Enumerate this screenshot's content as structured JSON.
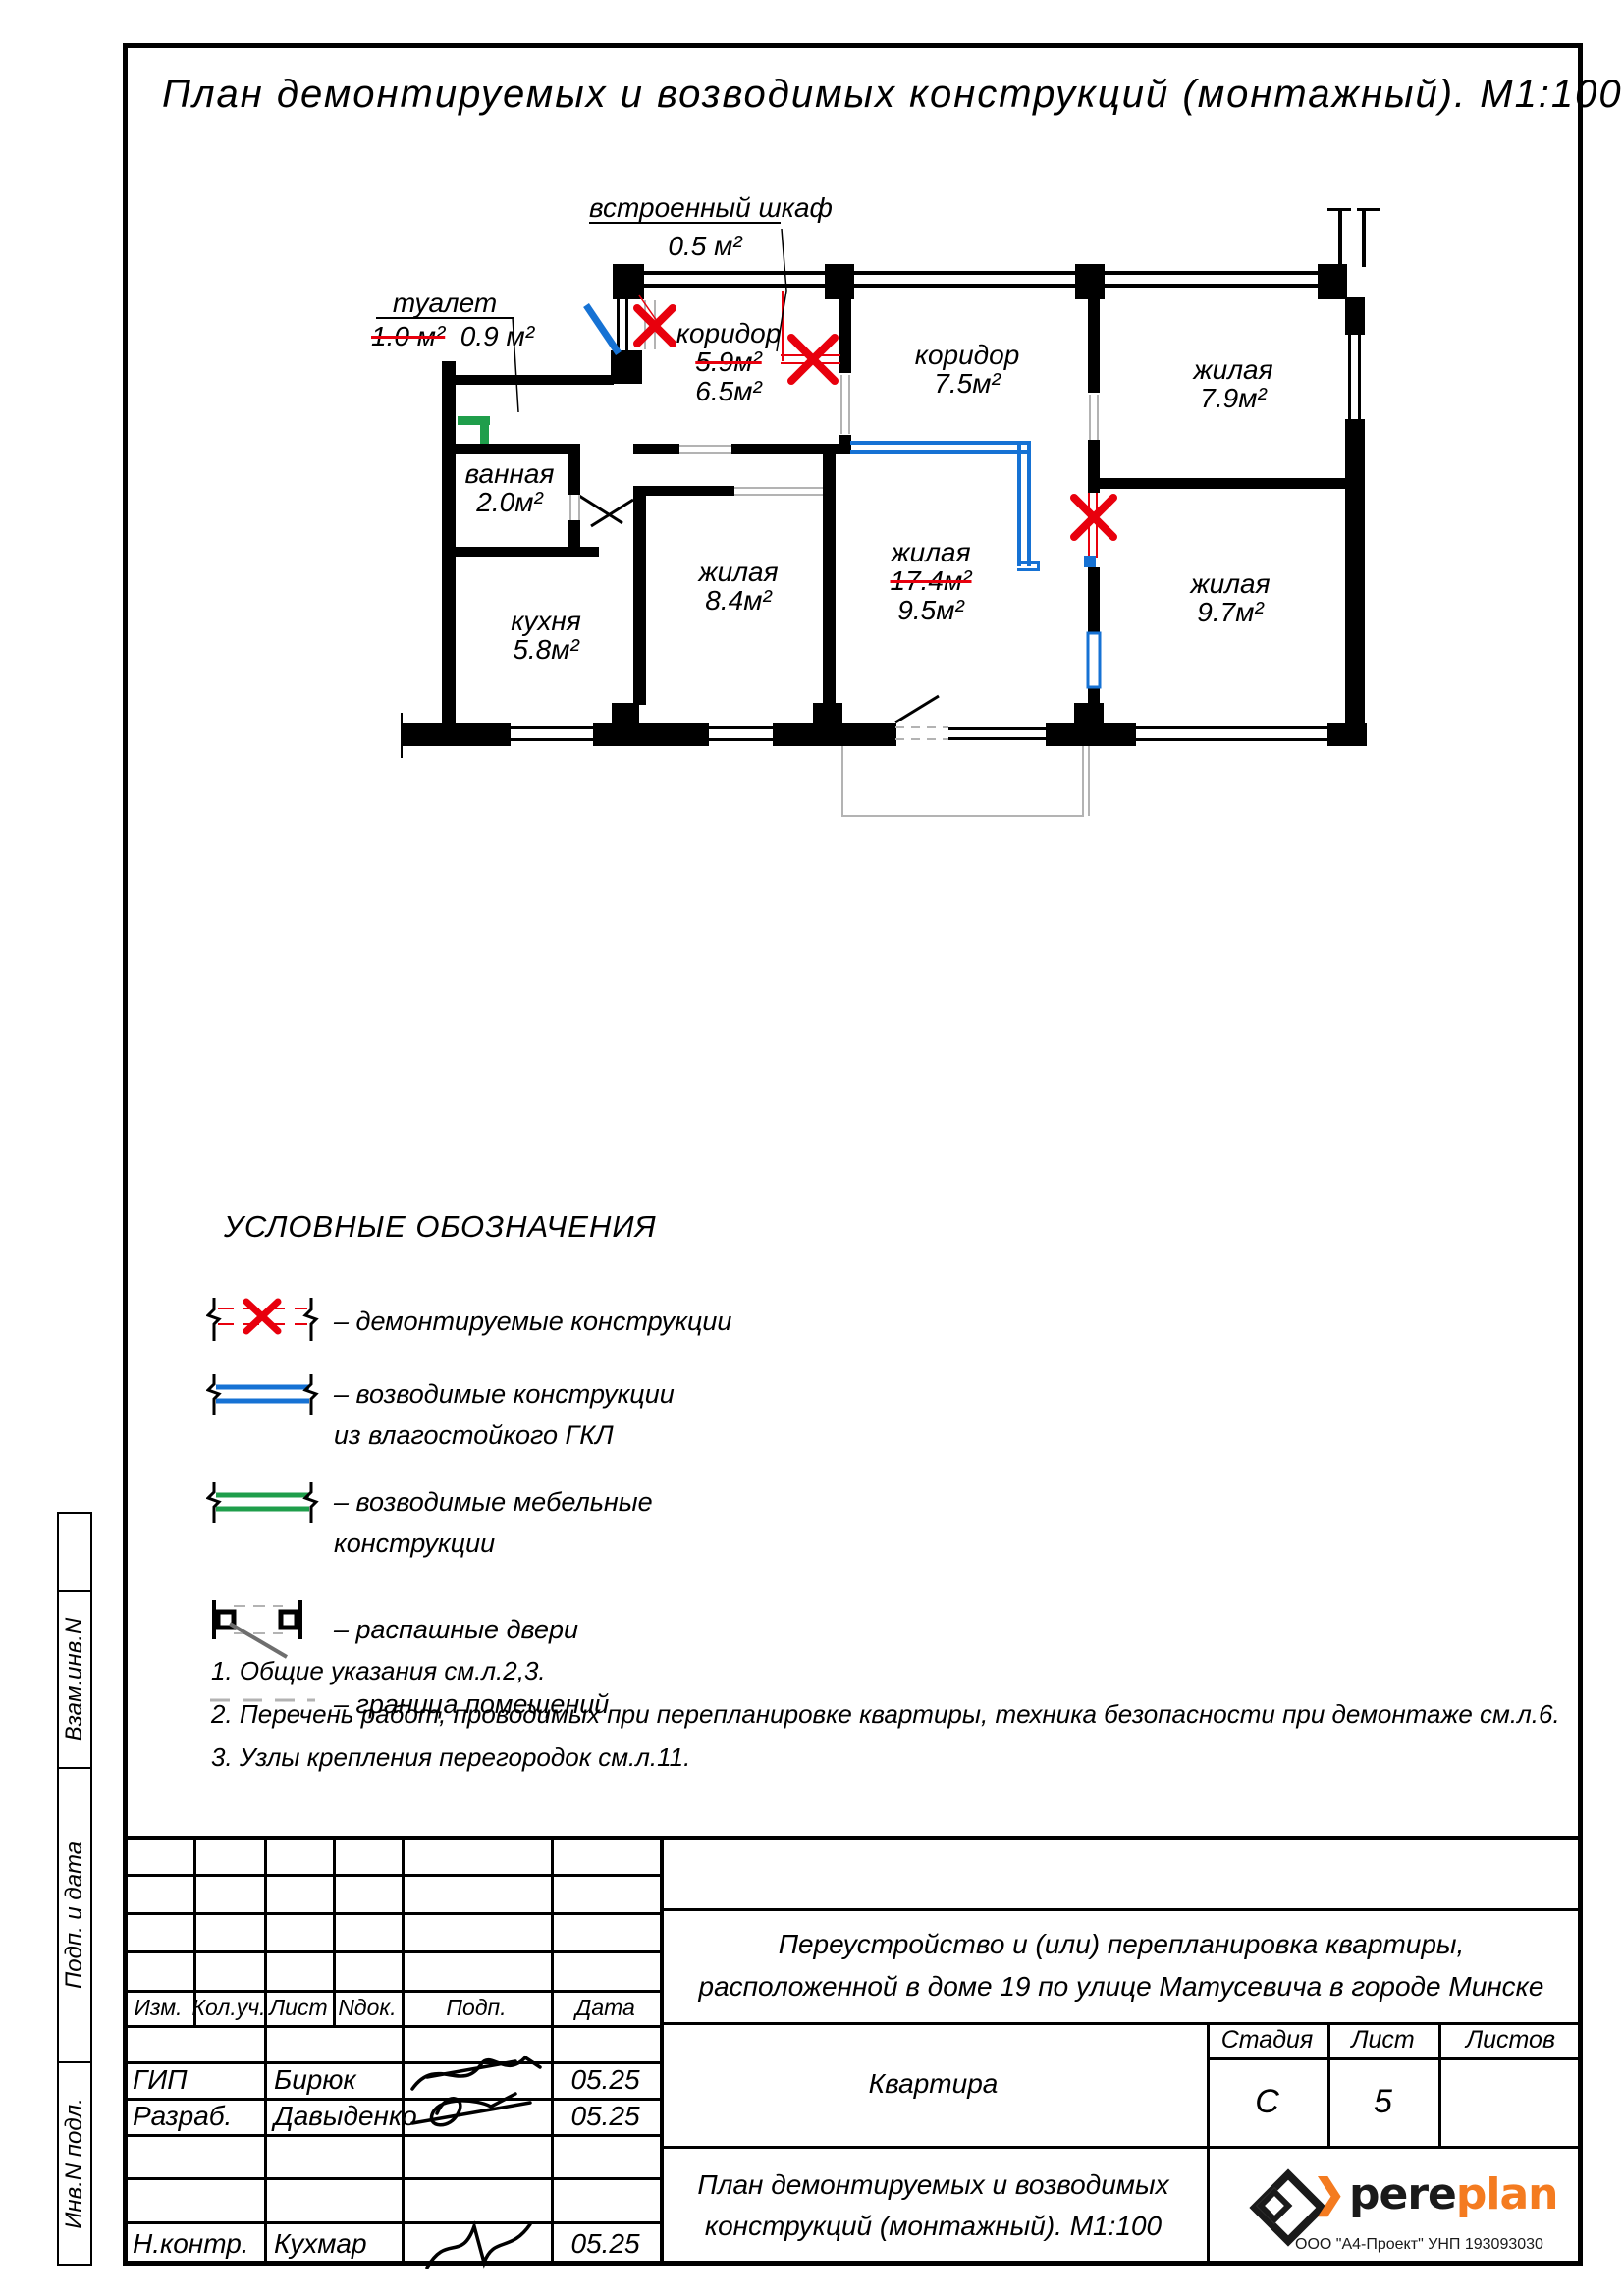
{
  "page_title": "План демонтируемых и возводимых конструкций (монтажный). М1:100",
  "rooms": {
    "toilet": {
      "name": "туалет",
      "area_old": "1.0 м²",
      "area_new": "0.9 м²"
    },
    "closet": {
      "name": "встроенный шкаф",
      "area": "0.5 м²"
    },
    "corridor_left": {
      "name": "коридор",
      "area_old": "5.9м²",
      "area_new": "6.5м²"
    },
    "corridor_right": {
      "name": "коридор",
      "area": "7.5м²"
    },
    "living_top_right": {
      "name": "жилая",
      "area": "7.9м²"
    },
    "living_center": {
      "name": "жилая",
      "area_old": "17.4м²",
      "area_new": "9.5м²"
    },
    "living_left": {
      "name": "жилая",
      "area": "8.4м²"
    },
    "living_bottom_right": {
      "name": "жилая",
      "area": "9.7м²"
    },
    "bathroom": {
      "name": "ванная",
      "area": "2.0м²"
    },
    "kitchen": {
      "name": "кухня",
      "area": "5.8м²"
    }
  },
  "legend": {
    "title": "УСЛОВНЫЕ ОБОЗНАЧЕНИЯ",
    "items": [
      {
        "label": "–  демонтируемые конструкции",
        "label2": ""
      },
      {
        "label": "–  возводимые конструкции",
        "label2": "из влагостойкого ГКЛ"
      },
      {
        "label": "–  возводимые мебельные",
        "label2": "конструкции"
      },
      {
        "label": "–  распашные двери",
        "label2": ""
      },
      {
        "label": "–  граница помещений",
        "label2": ""
      }
    ]
  },
  "notes": [
    "1.  Общие указания см.л.2,3.",
    "2.  Перечень работ, проводимых при перепланировке квартиры, техника безопасности при демонтаже см.л.6.",
    "3.  Узлы крепления перегородок см.л.11."
  ],
  "titleblock": {
    "cols": [
      "Изм.",
      "Кол.уч.",
      "Лист",
      "Nдок.",
      "Подп.",
      "Дата"
    ],
    "rows": [
      {
        "role": "ГИП",
        "name": "Бирюк",
        "date": "05.25"
      },
      {
        "role": "Разраб.",
        "name": "Давыденко",
        "date": "05.25"
      },
      {
        "role": "Н.контр.",
        "name": "Кухмар",
        "date": "05.25"
      }
    ],
    "project_line1": "Переустройство и  (или)  перепланировка квартиры,",
    "project_line2": "расположенной в доме  19  по улице Матусевича  в городе Минске",
    "object": "Квартира",
    "stage_label": "Стадия",
    "stage": "С",
    "sheet_label": "Лист",
    "sheet": "5",
    "sheets_label": "Листов",
    "sheets": "",
    "doc_line1": "План демонтируемых и возводимых",
    "doc_line2": "конструкций (монтажный). М1:100",
    "side_labels": [
      "Взам.инв.N",
      "Подп. и дата",
      "Инв.N подл."
    ],
    "logo": {
      "part1": "pere",
      "part2": "plan",
      "sub": "ООО \"А4-Проект\" УНП 193093030"
    }
  },
  "colors": {
    "red": "#e8000d",
    "blue": "#1672d4",
    "green": "#1f9e4b",
    "gray": "#b3b3b3",
    "orange": "#f47b20"
  }
}
